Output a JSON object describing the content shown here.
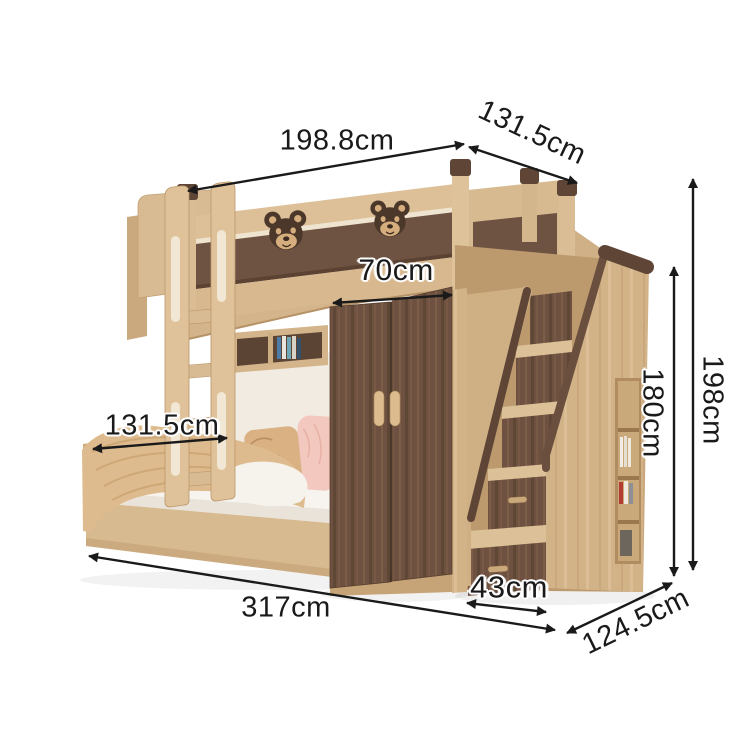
{
  "product": {
    "subject": "kids bunk bed with wardrobe, storage staircase and ladder",
    "decor_bear_count": 2
  },
  "dimensions": {
    "upper_bed_length": "198.8cm",
    "upper_bed_depth": "131.5cm",
    "wardrobe_width": "70cm",
    "lower_bed_width": "131.5cm",
    "stair_drawer_width": "43cm",
    "total_length": "317cm",
    "staircase_depth": "124.5cm",
    "total_height": "198cm",
    "staircase_height": "180cm"
  },
  "colors": {
    "background": "#ffffff",
    "wood_light": "#d6b88e",
    "wood_walnut": "#6e5140",
    "walnut_trim": "#5e4536",
    "text": "#1a1a1a",
    "pillow_pink": "#f3c9bf",
    "blanket_beige": "#debb8e",
    "bedding_white": "#f7f4ef",
    "wall_cream": "#f2ebe2"
  },
  "icons": [
    {
      "name": "bear-face-icon",
      "count": 2
    }
  ]
}
